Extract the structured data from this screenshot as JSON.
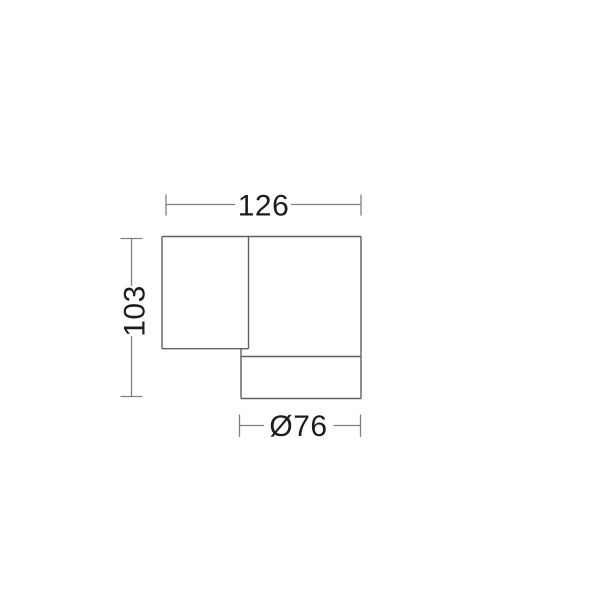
{
  "diagram": {
    "type": "technical-dimension-drawing",
    "dimensions": {
      "width": {
        "label": "126",
        "orientation": "horizontal",
        "position": "top"
      },
      "height": {
        "label": "103",
        "orientation": "vertical",
        "position": "left"
      },
      "diameter": {
        "label": "Ø76",
        "orientation": "horizontal",
        "position": "bottom"
      }
    },
    "colors": {
      "outline": "#5f6063",
      "dimension_lines": "#7f8083",
      "text": "#1d1d1b",
      "background": "#ffffff"
    }
  }
}
